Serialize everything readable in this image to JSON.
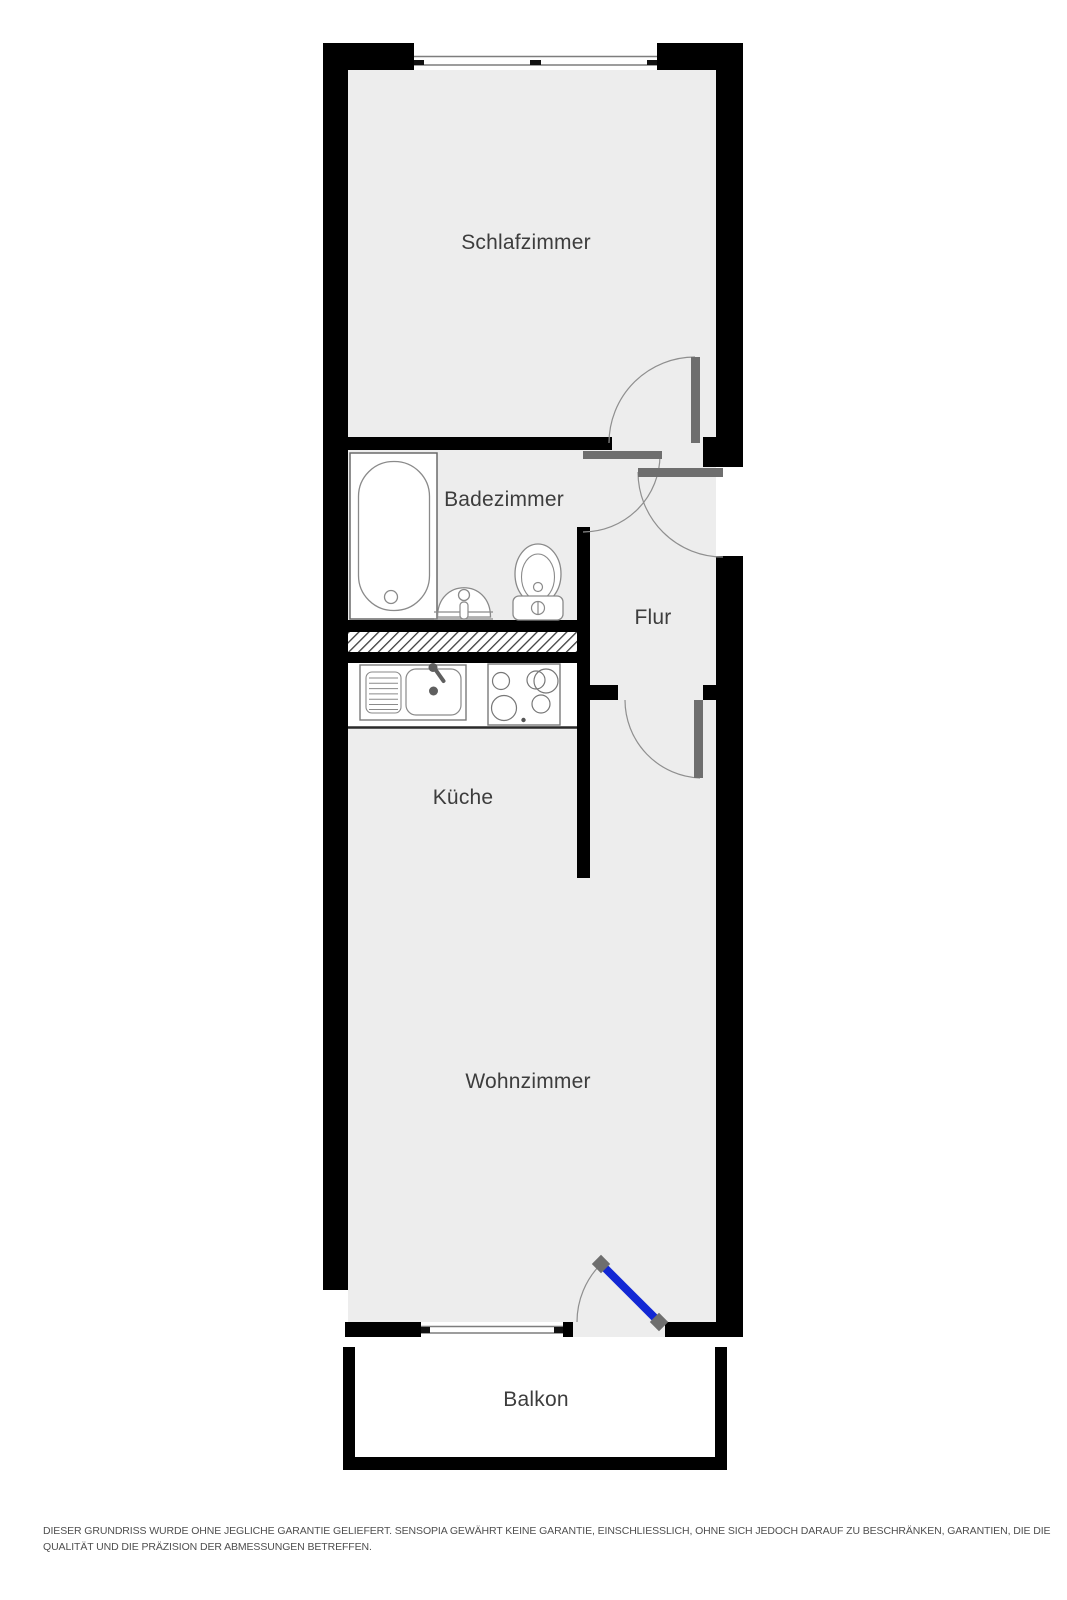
{
  "floorplan": {
    "rooms": [
      {
        "id": "schlafzimmer",
        "label": "Schlafzimmer"
      },
      {
        "id": "badezimmer",
        "label": "Badezimmer"
      },
      {
        "id": "flur",
        "label": "Flur"
      },
      {
        "id": "kueche",
        "label": "Küche"
      },
      {
        "id": "wohnzimmer",
        "label": "Wohnzimmer"
      },
      {
        "id": "balkon",
        "label": "Balkon"
      }
    ],
    "fixtures": [
      "bathtub",
      "washbasin",
      "toilet",
      "kitchen-sink",
      "stove"
    ],
    "doors": [
      "bedroom-door",
      "bathroom-door",
      "entry-door",
      "hall-door",
      "balcony-door"
    ],
    "windows": [
      "bedroom-window",
      "livingroom-window"
    ],
    "colors": {
      "wall": "#000000",
      "floor": "#ededed",
      "door_leaf": "#6e6e6e",
      "balcony_door": "#1228d4",
      "arc": "#8f8f8f",
      "fixture_line": "#8a8a8a",
      "fixture_line_dark": "#6a6a6a",
      "hatch_line": "#3d3d3d",
      "window_line": "#7d7d7d",
      "label_text": "#3d3d3d",
      "disclaimer_text": "#4f4f4f"
    }
  },
  "disclaimer": {
    "line1": "DIESER GRUNDRISS WURDE OHNE JEGLICHE GARANTIE GELIEFERT. SENSOPIA GEWÄHRT KEINE GARANTIE, EINSCHLIESSLICH, OHNE SICH JEDOCH DARAUF ZU BESCHRÄNKEN, GARANTIEN, DIE DIE",
    "line2": "QUALITÄT UND DIE PRÄZISION DER ABMESSUNGEN BETREFFEN."
  }
}
